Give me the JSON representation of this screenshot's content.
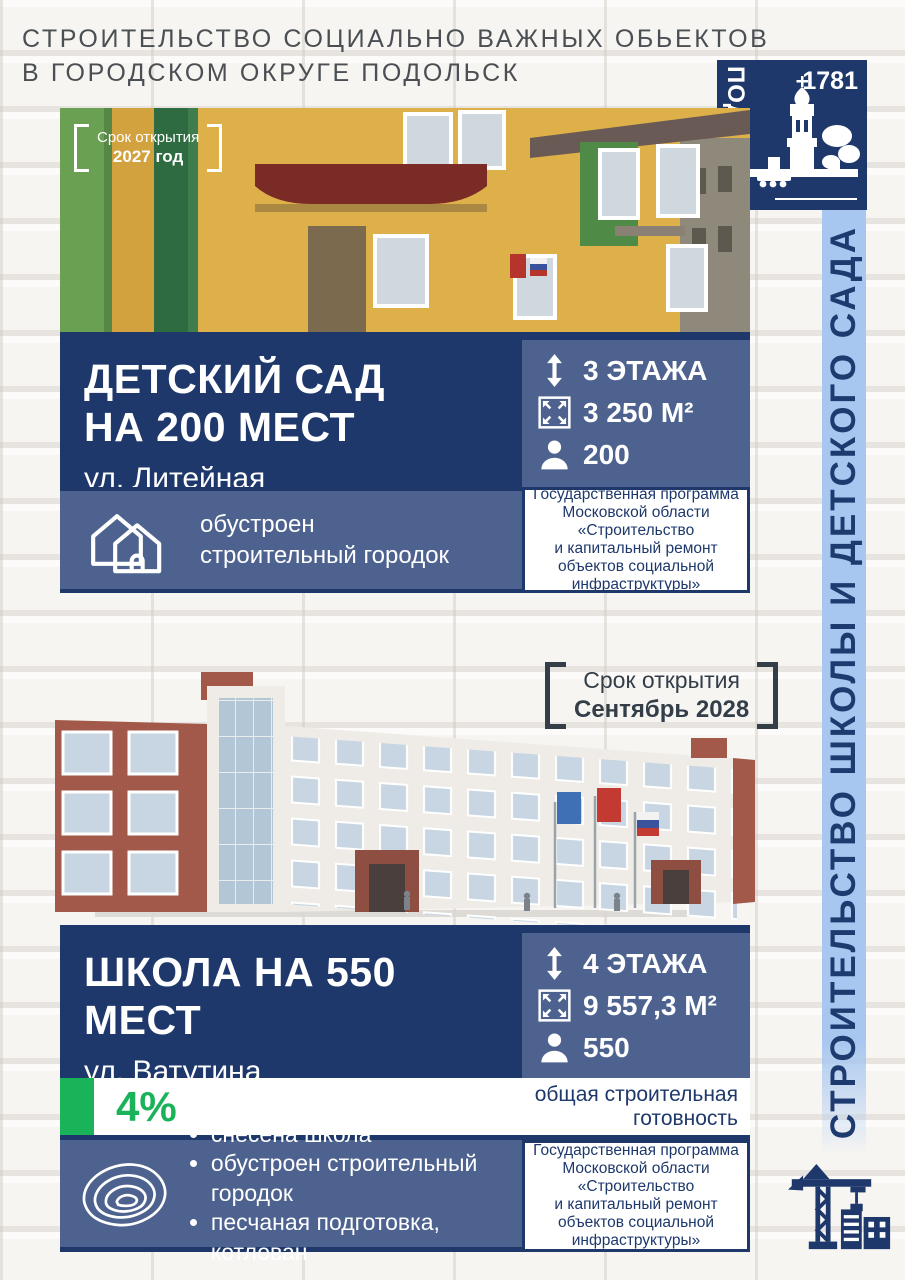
{
  "header": {
    "line1": "СТРОИТЕЛЬСТВО СОЦИАЛЬНО ВАЖНЫХ ОБЬЕКТОВ",
    "line2": "В ГОРОДСКОМ ОКРУГЕ ПОДОЛЬСК"
  },
  "logo": {
    "city": "ПОДОЛЬСК",
    "year": "1781"
  },
  "ribbon": {
    "text": "СТРОИТЕЛЬСТВО ШКОЛЫ И ДЕТСКОГО САДА"
  },
  "program_note": "Государственная программа\nМосковской области\n«Строительство\nи капитальный ремонт\nобъектов социальной\nинфраструктуры»",
  "colors": {
    "navy": "#1e386b",
    "slate": "#4e628f",
    "ribbon_blue": "#a8c7f0",
    "green": "#1bb35a"
  },
  "cards": [
    {
      "opening_label": "Срок открытия",
      "opening_value": "2027 год",
      "title": "ДЕТСКИЙ САД\nНА 200 МЕСТ",
      "address": "ул. Литейная",
      "stats": [
        {
          "icon": "floors-icon",
          "value": "3 ЭТАЖА"
        },
        {
          "icon": "area-icon",
          "value": "3 250 М²"
        },
        {
          "icon": "capacity-icon",
          "value": "200"
        }
      ],
      "status_text": "обустроен строительный городок"
    },
    {
      "opening_label": "Срок открытия",
      "opening_value": "Сентябрь 2028",
      "title": "ШКОЛА НА 550 МЕСТ",
      "address": "ул. Ватутина",
      "stats": [
        {
          "icon": "floors-icon",
          "value": "4 ЭТАЖА"
        },
        {
          "icon": "area-icon",
          "value": "9 557,3 М²"
        },
        {
          "icon": "capacity-icon",
          "value": "550"
        }
      ],
      "progress_percent": "4%",
      "progress_label": "общая строительная\nготовность",
      "milestones": [
        "снесена школа",
        "обустроен строительный городок",
        "песчаная подготовка, котлован"
      ]
    }
  ]
}
